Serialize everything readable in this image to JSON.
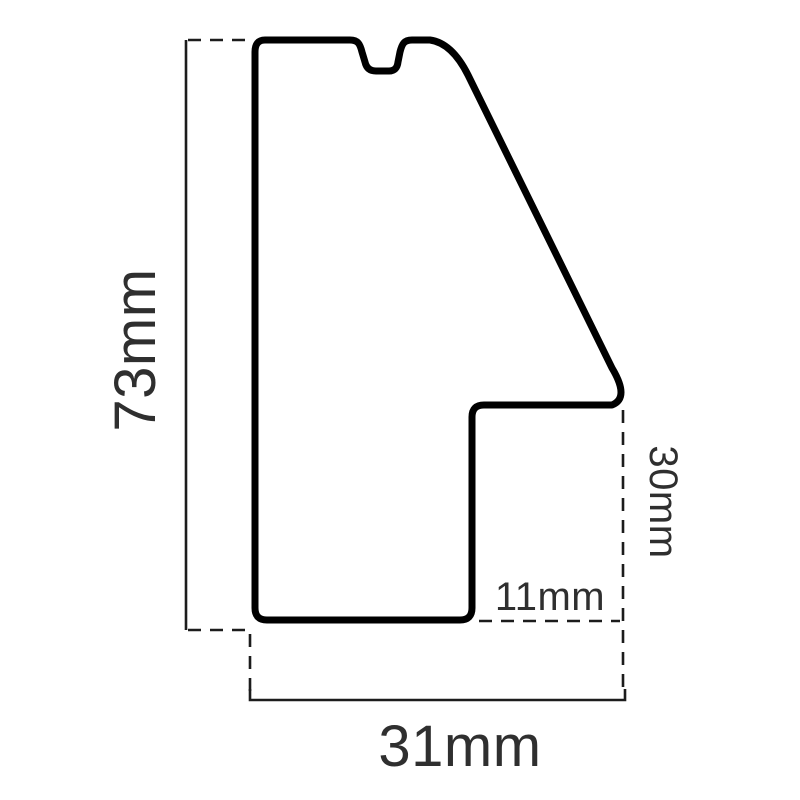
{
  "colors": {
    "background": "#ffffff",
    "profile_outline": "#000000",
    "dimension_lines": "#1c1c1c",
    "dimension_text": "#2f2f2f"
  },
  "dimension_labels": {
    "height": "73mm",
    "width": "31mm",
    "right_height": "30mm",
    "bottom_inset": "11mm"
  }
}
